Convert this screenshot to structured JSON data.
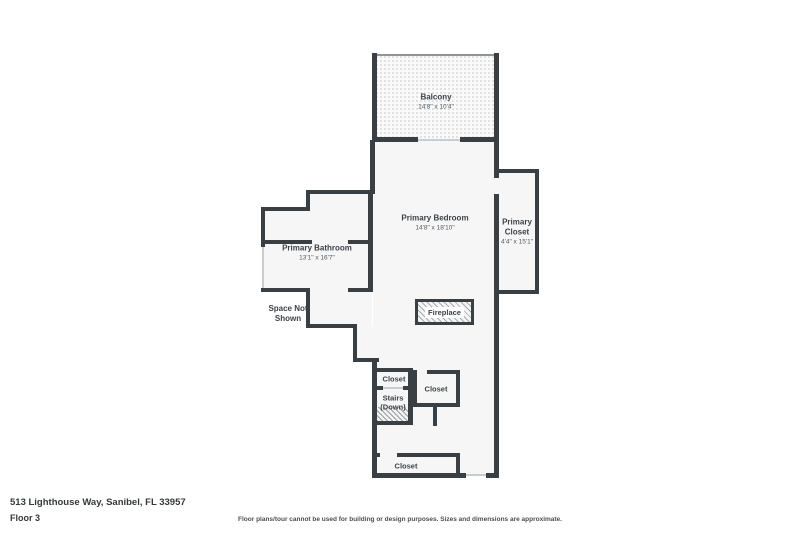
{
  "title": "Floor plan",
  "rooms": {
    "balcony": {
      "name": "Balcony",
      "dims": "14'8\" x 10'4\""
    },
    "primary_bedroom": {
      "name": "Primary Bedroom",
      "dims": "14'8\" x 18'10\""
    },
    "primary_closet": {
      "name": "Primary Closet",
      "dims": "4'4\" x 15'1\""
    },
    "primary_bathroom": {
      "name": "Primary Bathroom",
      "dims": "13'1\" x 16'7\""
    },
    "space_not_shown": {
      "name": "Space Not Shown"
    },
    "fireplace": {
      "name": "Fireplace"
    },
    "closet_top_left": {
      "name": "Closet"
    },
    "stairs": {
      "name": "Stairs (Down)"
    },
    "closet_right": {
      "name": "Closet"
    },
    "closet_bottom": {
      "name": "Closet"
    }
  },
  "footer": {
    "address": "513 Lighthouse Way, Sanibel, FL 33957",
    "floor": "Floor 3",
    "disclaimer": "Floor plans/tour cannot be used for building or design purposes. Sizes and dimensions are approximate."
  },
  "colors": {
    "wall": "#3a3f44",
    "floor": "#f6f6f6",
    "text": "#3d4247"
  }
}
